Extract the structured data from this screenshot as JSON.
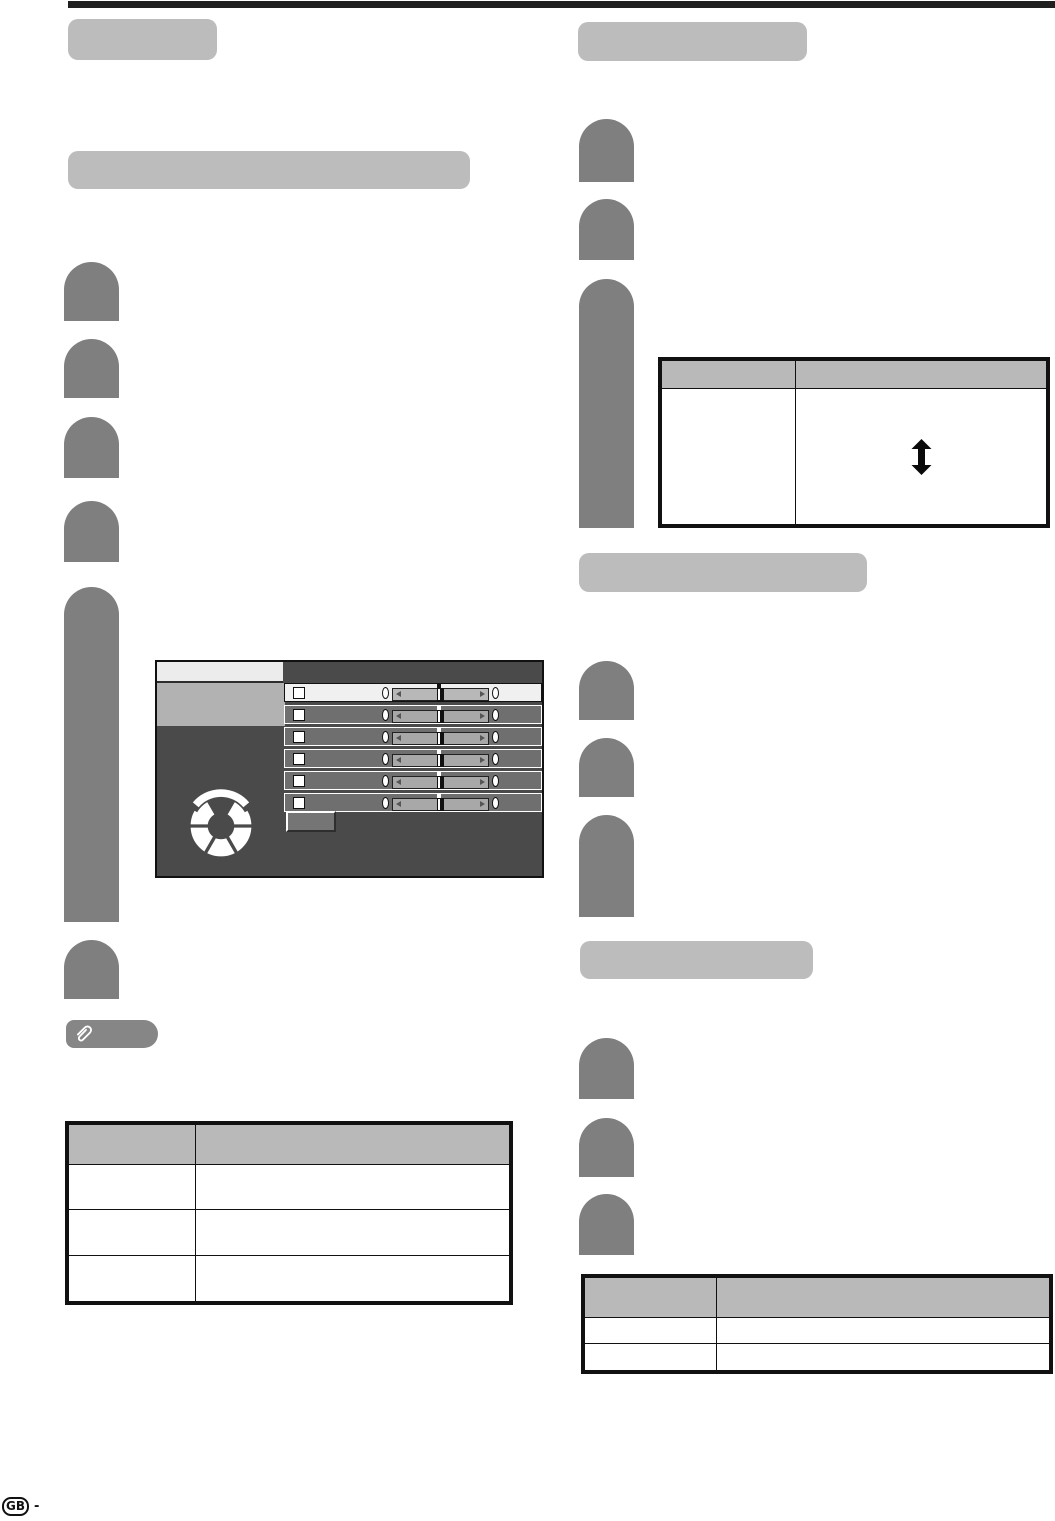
{
  "page": {
    "kind": "tv-manual-page",
    "footer": {
      "region_label": "GB",
      "separator": "-"
    }
  },
  "colors": {
    "top_rule": "#1f1f1f",
    "heading_placeholder": "#bcbcbc",
    "step_placeholder": "#7f7f7f",
    "note_pill": "#868686",
    "table_header": "#b9b9b9",
    "table_border": "#111111",
    "osd_background": "#4a4a4a",
    "osd_tab": "#ececec",
    "osd_selected_item": "#b2b2b2",
    "osd_row": "#6f6f6f",
    "osd_row_active": "#f0f0f0"
  },
  "headings": {
    "left_small": "",
    "left_long": "",
    "right_1": "",
    "right_2": "",
    "right_3": ""
  },
  "left_column": {
    "steps": [
      {},
      {},
      {},
      {},
      {
        "tall": true
      },
      {}
    ],
    "note": {
      "icon": "paperclip-icon",
      "label": ""
    },
    "table": {
      "headers": [
        "",
        ""
      ],
      "rows": [
        [
          "",
          ""
        ],
        [
          "",
          ""
        ],
        [
          "",
          ""
        ]
      ]
    }
  },
  "right_column": {
    "steps_top": [
      {},
      {},
      {
        "tall": true
      }
    ],
    "steps_mid": [
      {},
      {},
      {
        "tall": true
      }
    ],
    "steps_bottom": [
      {},
      {},
      {}
    ],
    "table_top": {
      "headers": [
        "",
        ""
      ],
      "rows": [
        [
          "",
          ""
        ]
      ],
      "body_icon": "up-down-arrow-icon"
    },
    "table_bottom": {
      "headers": [
        "",
        ""
      ],
      "rows": [
        [
          "",
          ""
        ],
        [
          "",
          ""
        ]
      ]
    }
  },
  "osd_menu": {
    "tab_label": "",
    "selected_item_label": "",
    "button_label": "",
    "nav_icon": "nav-wheel-icon",
    "slider_rows": [
      {
        "checked": false,
        "left_value": "0",
        "right_value": "0",
        "active": true
      },
      {
        "checked": false,
        "left_value": "0",
        "right_value": "0",
        "active": false
      },
      {
        "checked": false,
        "left_value": "0",
        "right_value": "0",
        "active": false
      },
      {
        "checked": false,
        "left_value": "0",
        "right_value": "0",
        "active": false
      },
      {
        "checked": false,
        "left_value": "0",
        "right_value": "0",
        "active": false
      },
      {
        "checked": false,
        "left_value": "0",
        "right_value": "0",
        "active": false
      }
    ]
  }
}
